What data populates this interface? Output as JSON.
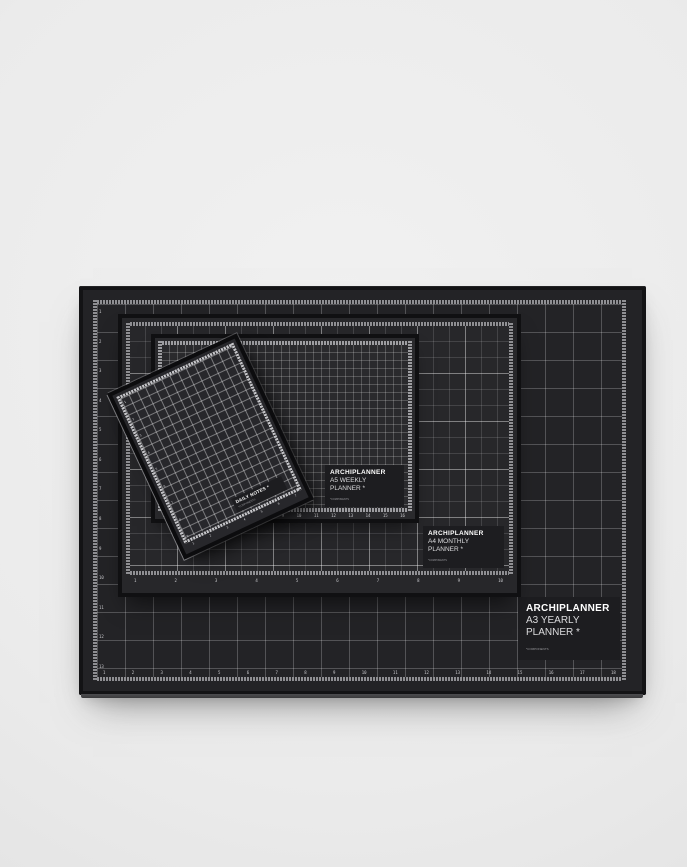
{
  "brand_color": "#ffffff",
  "mat_color": "#232326",
  "background_color": "#ebebeb",
  "a3": {
    "brand": "ARCHIPLANNER",
    "line1": "A3 YEARLY",
    "line2": "PLANNER *",
    "footnote": "*COMPONENTS",
    "ruler_bottom": [
      "1",
      "2",
      "3",
      "4",
      "5",
      "6",
      "7",
      "8",
      "9",
      "10",
      "11",
      "12",
      "13",
      "14",
      "15",
      "16",
      "17",
      "18"
    ],
    "ruler_left": [
      "1",
      "2",
      "3",
      "4",
      "5",
      "6",
      "7",
      "8",
      "9",
      "10",
      "11",
      "12",
      "13"
    ]
  },
  "a4": {
    "brand": "ARCHIPLANNER",
    "line1": "A4 MONTHLY",
    "line2": "PLANNER *",
    "footnote": "*COMPONENTS",
    "ruler_bottom": [
      "1",
      "2",
      "3",
      "4",
      "5",
      "6",
      "7",
      "8",
      "9",
      "10"
    ]
  },
  "a5": {
    "brand": "ARCHIPLANNER",
    "line1": "A5 WEEKLY",
    "line2": "PLANNER *",
    "footnote": "*COMPONENTS",
    "ruler_bottom": [
      "1",
      "2",
      "3",
      "4",
      "5",
      "6",
      "7",
      "8",
      "9",
      "10",
      "11",
      "12",
      "13",
      "14",
      "15",
      "16"
    ]
  },
  "a6": {
    "line1": "DAILY NOTES *",
    "footnote": "*COMPONENTS",
    "ruler_bottom": [
      "1",
      "2",
      "3",
      "4",
      "5",
      "6",
      "7"
    ],
    "ruler_left": [
      "1",
      "2",
      "3",
      "4",
      "5",
      "6",
      "7",
      "8",
      "9"
    ]
  }
}
